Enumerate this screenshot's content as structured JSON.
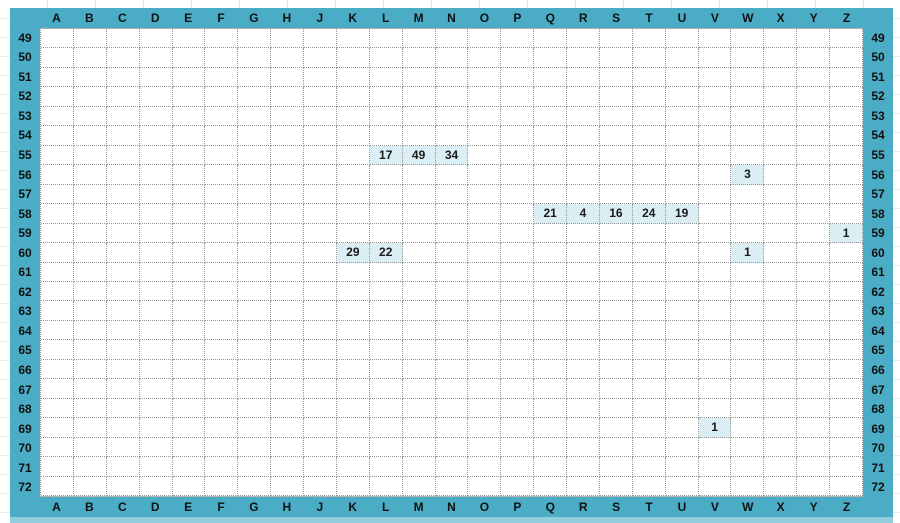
{
  "grid": {
    "columns": [
      "A",
      "B",
      "C",
      "D",
      "E",
      "F",
      "G",
      "H",
      "J",
      "K",
      "L",
      "M",
      "N",
      "O",
      "P",
      "Q",
      "R",
      "S",
      "T",
      "U",
      "V",
      "W",
      "X",
      "Y",
      "Z"
    ],
    "rows": [
      49,
      50,
      51,
      52,
      53,
      54,
      55,
      56,
      57,
      58,
      59,
      60,
      61,
      62,
      63,
      64,
      65,
      66,
      67,
      68,
      69,
      70,
      71,
      72
    ],
    "cells": [
      {
        "col": "L",
        "row": 55,
        "value": "17"
      },
      {
        "col": "M",
        "row": 55,
        "value": "49"
      },
      {
        "col": "N",
        "row": 55,
        "value": "34"
      },
      {
        "col": "W",
        "row": 56,
        "value": "3"
      },
      {
        "col": "Q",
        "row": 58,
        "value": "21"
      },
      {
        "col": "R",
        "row": 58,
        "value": "4"
      },
      {
        "col": "S",
        "row": 58,
        "value": "16"
      },
      {
        "col": "T",
        "row": 58,
        "value": "24"
      },
      {
        "col": "U",
        "row": 58,
        "value": "19"
      },
      {
        "col": "Z",
        "row": 59,
        "value": "1"
      },
      {
        "col": "K",
        "row": 60,
        "value": "29"
      },
      {
        "col": "L",
        "row": 60,
        "value": "22"
      },
      {
        "col": "W",
        "row": 60,
        "value": "1"
      },
      {
        "col": "V",
        "row": 69,
        "value": "1"
      }
    ]
  },
  "colors": {
    "band": "#4bacc6",
    "band_light": "#92cddc",
    "cell_highlight": "#daeef3",
    "grid_line": "#969696",
    "label_text": "#111111",
    "value_text": "#1a1a1a"
  }
}
